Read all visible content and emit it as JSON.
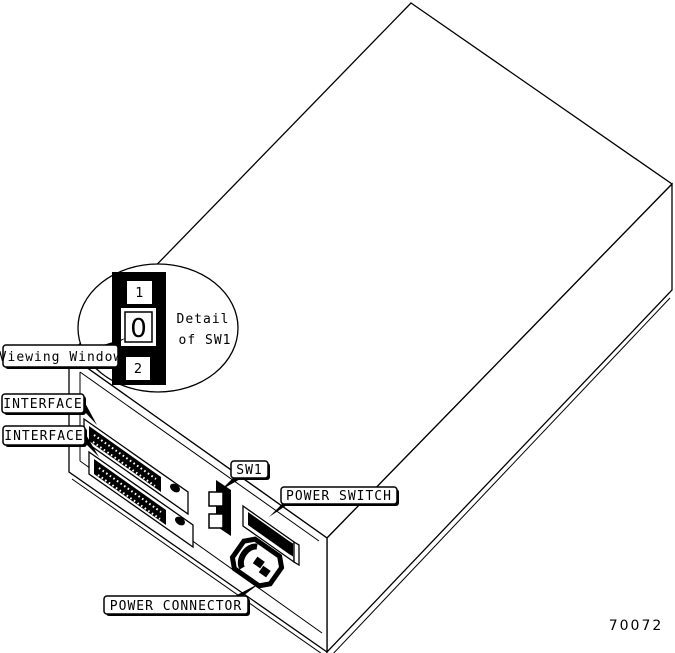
{
  "figure": {
    "number": "70072",
    "colors": {
      "line": "#000000",
      "background": "#ffffff"
    },
    "detail_balloon": {
      "caption_line1": "Detail",
      "caption_line2": "of SW1",
      "switch_positions": [
        "1",
        "0",
        "2"
      ]
    },
    "labels": {
      "viewing_window": "Viewing Window",
      "interface_1": "INTERFACE",
      "interface_2": "INTERFACE",
      "sw1": "SW1",
      "power_switch": "POWER SWITCH",
      "power_connector": "POWER CONNECTOR"
    }
  }
}
